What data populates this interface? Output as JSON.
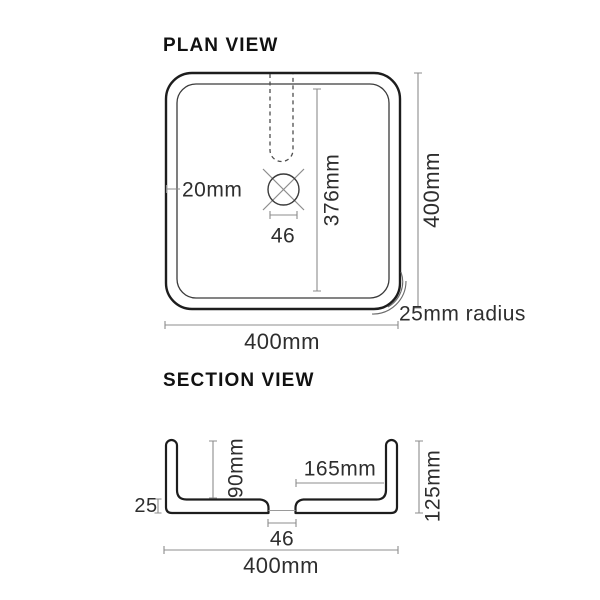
{
  "plan": {
    "title": "PLAN VIEW",
    "dim_rim_thickness": "20mm",
    "dim_inner_length": "376mm",
    "dim_drain_width": "46",
    "dim_overall_height": "400mm",
    "dim_overall_width": "400mm",
    "radius_note": "25mm radius"
  },
  "section": {
    "title": "SECTION VIEW",
    "dim_bowl_depth": "90mm",
    "dim_drain_to_wall": "165mm",
    "dim_overall_height": "125mm",
    "dim_base_thickness": "25",
    "dim_drain_width": "46",
    "dim_overall_width": "400mm"
  },
  "colors": {
    "outline": "#1d1d1d",
    "thin_line": "#3a3a3a",
    "dimension_line": "#8c8c8c",
    "text": "#2e2e2e",
    "background": "#ffffff"
  }
}
